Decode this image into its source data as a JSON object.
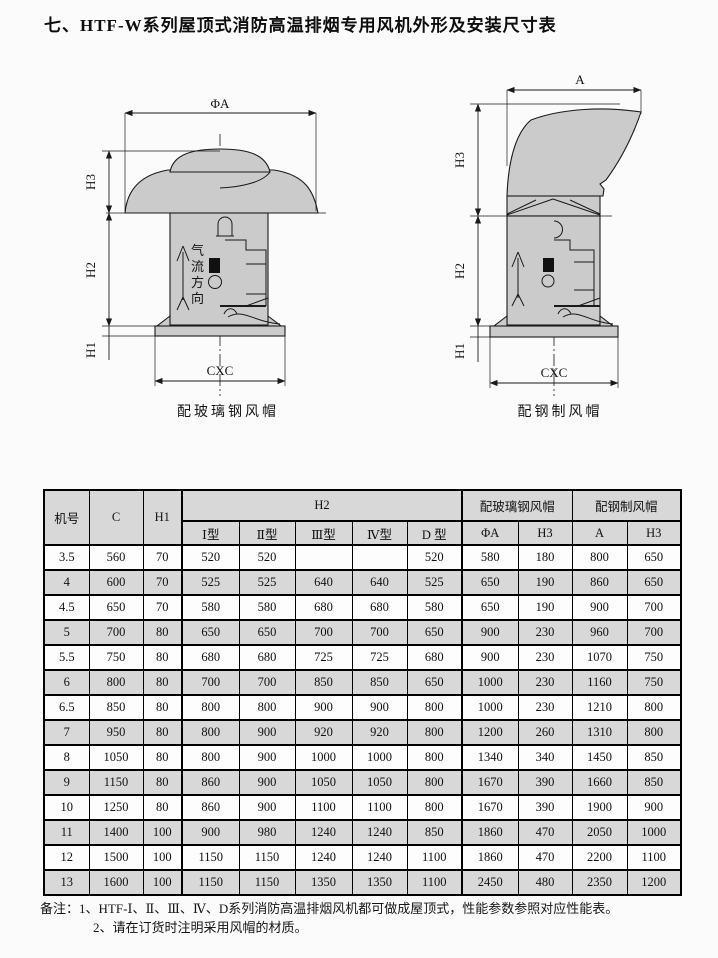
{
  "page": {
    "title": "七、HTF-W系列屋顶式消防高温排烟专用风机外形及安装尺寸表"
  },
  "diagrams": {
    "left": {
      "caption": "配玻璃钢风帽",
      "airflow_chars": [
        "气",
        "流",
        "方",
        "向"
      ],
      "dims": {
        "diameter": "ΦA",
        "h3": "H3",
        "h2": "H2",
        "h1": "H1",
        "base": "CXC"
      }
    },
    "right": {
      "caption": "配钢制风帽",
      "dims": {
        "width": "A",
        "h3": "H3",
        "h2": "H2",
        "h1": "H1",
        "base": "CXC"
      }
    }
  },
  "table": {
    "col_groups": {
      "model": "机号",
      "c": "C",
      "h1": "H1",
      "h2": "H2",
      "fiberglass": "配玻璃钢风帽",
      "steel": "配钢制风帽"
    },
    "sub_headers": [
      "Ⅰ型",
      "Ⅱ型",
      "Ⅲ型",
      "Ⅳ型",
      "D 型",
      "ΦA",
      "H3",
      "A",
      "H3"
    ],
    "rows": [
      [
        "3.5",
        "560",
        "70",
        "520",
        "520",
        "",
        "",
        "520",
        "580",
        "180",
        "800",
        "650"
      ],
      [
        "4",
        "600",
        "70",
        "525",
        "525",
        "640",
        "640",
        "525",
        "650",
        "190",
        "860",
        "650"
      ],
      [
        "4.5",
        "650",
        "70",
        "580",
        "580",
        "680",
        "680",
        "580",
        "650",
        "190",
        "900",
        "700"
      ],
      [
        "5",
        "700",
        "80",
        "650",
        "650",
        "700",
        "700",
        "650",
        "900",
        "230",
        "960",
        "700"
      ],
      [
        "5.5",
        "750",
        "80",
        "680",
        "680",
        "725",
        "725",
        "680",
        "900",
        "230",
        "1070",
        "750"
      ],
      [
        "6",
        "800",
        "80",
        "700",
        "700",
        "850",
        "850",
        "650",
        "1000",
        "230",
        "1160",
        "750"
      ],
      [
        "6.5",
        "850",
        "80",
        "800",
        "800",
        "900",
        "900",
        "800",
        "1000",
        "230",
        "1210",
        "800"
      ],
      [
        "7",
        "950",
        "80",
        "800",
        "900",
        "920",
        "920",
        "800",
        "1200",
        "260",
        "1310",
        "800"
      ],
      [
        "8",
        "1050",
        "80",
        "800",
        "900",
        "1000",
        "1000",
        "800",
        "1340",
        "340",
        "1450",
        "850"
      ],
      [
        "9",
        "1150",
        "80",
        "860",
        "900",
        "1050",
        "1050",
        "800",
        "1670",
        "390",
        "1660",
        "850"
      ],
      [
        "10",
        "1250",
        "80",
        "860",
        "900",
        "1100",
        "1100",
        "800",
        "1670",
        "390",
        "1900",
        "900"
      ],
      [
        "11",
        "1400",
        "100",
        "900",
        "980",
        "1240",
        "1240",
        "850",
        "1860",
        "470",
        "2050",
        "1000"
      ],
      [
        "12",
        "1500",
        "100",
        "1150",
        "1150",
        "1240",
        "1240",
        "1100",
        "1860",
        "470",
        "2200",
        "1100"
      ],
      [
        "13",
        "1600",
        "100",
        "1150",
        "1150",
        "1350",
        "1350",
        "1100",
        "2450",
        "480",
        "2350",
        "1200"
      ]
    ]
  },
  "notes": {
    "prefix": "备注：",
    "items": [
      "1、HTF-Ⅰ、Ⅱ、Ⅲ、Ⅳ、D系列消防高温排烟风机都可做成屋顶式，性能参数参照对应性能表。",
      "2、请在订货时注明采用风帽的材质。"
    ]
  }
}
